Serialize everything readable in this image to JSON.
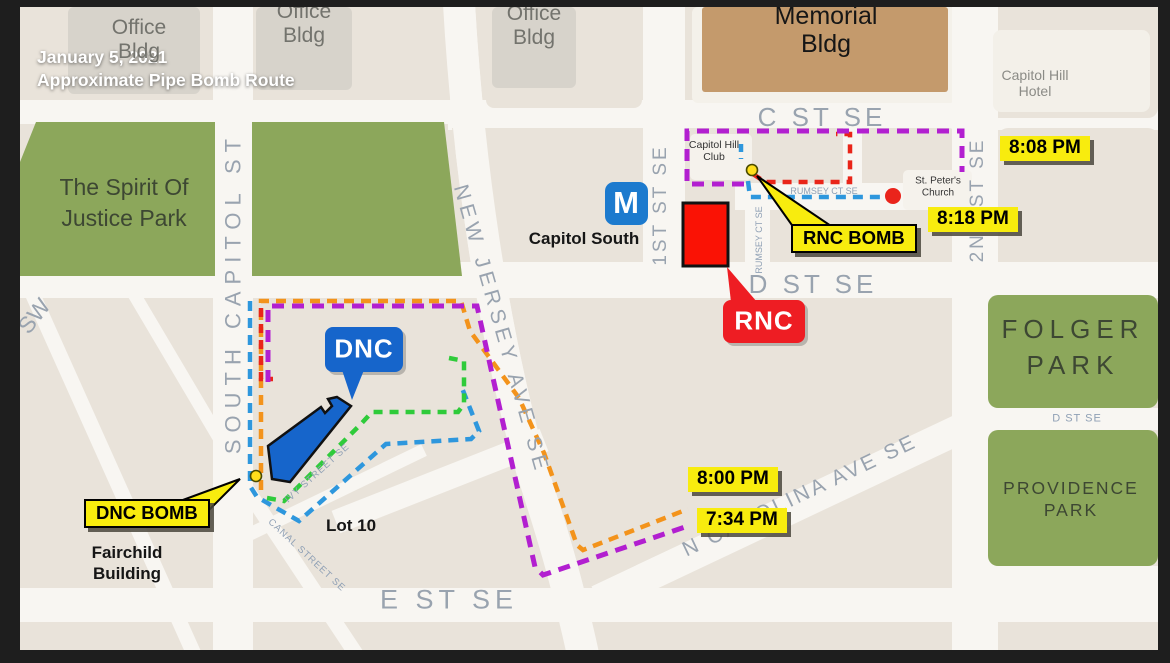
{
  "title": {
    "text": "January 5, 2021\nApproximate Pipe Bomb Route"
  },
  "parks": {
    "spirit": "The Spirit Of\nJustice Park",
    "folger": "FOLGER\nPARK",
    "providence": "PROVIDENCE\nPARK"
  },
  "buildings": {
    "office1": "Office\nBldg",
    "office2": "Office\nBldg",
    "office3": "Office\nBldg",
    "memorial": "Memorial\nBldg",
    "capitol_hill_hotel": "Capitol Hill\nHotel",
    "capitol_hill_club": "Capitol Hill\nClub",
    "st_peters": "St. Peter's\nChurch",
    "fairchild": "Fairchild\nBuilding",
    "lot10": "Lot 10"
  },
  "streets": {
    "south_capitol": "SOUTH CAPITOL ST",
    "sw": "SW",
    "new_jersey": "NEW JERSEY AVE SE",
    "first_st": "1ST ST SE",
    "second_st": "2ND ST SE",
    "c_st": "C ST SE",
    "d_st": "D ST SE",
    "d_st_small": "D ST SE",
    "e_st": "E ST SE",
    "n_carolina": "N CAROLINA AVE SE",
    "rumsey_h": "RUMSEY CT SE",
    "rumsey_v": "RUMSEY CT SE",
    "ivy": "IVY STREET SE",
    "canal": "CANAL STREET SE"
  },
  "metro": {
    "symbol": "M",
    "station": "Capitol South"
  },
  "callouts": {
    "dnc": "DNC",
    "rnc": "RNC",
    "dnc_bomb": "DNC BOMB",
    "rnc_bomb": "RNC BOMB"
  },
  "times": {
    "t734": "7:34 PM",
    "t800": "8:00 PM",
    "t808": "8:08 PM",
    "t818": "8:18 PM"
  },
  "colors": {
    "route_purple": "#b21fd0",
    "route_orange": "#f3931b",
    "route_blue": "#2e97dd",
    "route_green": "#2fcb3a",
    "route_red": "#e92519",
    "dnc_blue": "#1665cb",
    "rnc_red": "#ee1d23",
    "tag_yellow": "#f8ec0e",
    "park_green": "#8ca75b",
    "metro_blue": "#1c7ace",
    "memorial_tan": "#c49a6c"
  },
  "routes": [
    {
      "name": "purple-route",
      "color": "#b21fd0"
    },
    {
      "name": "orange-route",
      "color": "#f3931b"
    },
    {
      "name": "blue-route",
      "color": "#2e97dd"
    },
    {
      "name": "green-route",
      "color": "#2fcb3a"
    },
    {
      "name": "red-route",
      "color": "#e92519"
    }
  ]
}
